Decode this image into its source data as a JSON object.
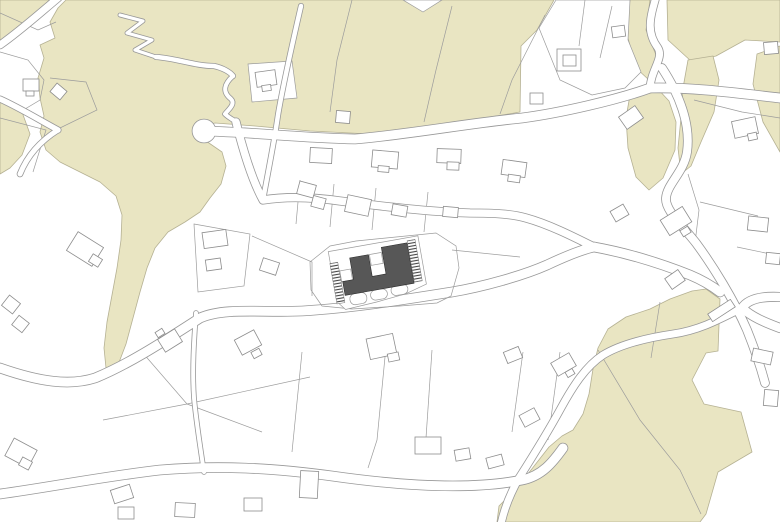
{
  "canvas": {
    "width": 780,
    "height": 522
  },
  "colors": {
    "background": "#ffffff",
    "vegetation_fill": "#e9e5c2",
    "vegetation_stroke": "#b5b193",
    "parcel_line": "#9c9c9c",
    "building_stroke": "#8d8d8d",
    "building_fill": "#ffffff",
    "road_edge": "#989898",
    "road_fill": "#ffffff",
    "project_fill": "#575757",
    "project_stroke": "#2e2e2e",
    "stair_hatch": "#454545",
    "plot_line": "#9c9c9c"
  },
  "vegetation": [
    {
      "name": "grove-top-left-corner",
      "points": "0,0 57,0 36,20 10,38 0,44"
    },
    {
      "name": "grove-main-north-mass",
      "points": "66,0 554,0 537,30 521,46 520,112 480,119 430,129 370,134 310,131 255,126 215,123 203,126 206,141 222,152 226,166 221,184 210,198 200,212 185,222 168,232 155,248 147,268 140,292 133,318 126,344 118,365 111,372 106,368 104,348 107,322 112,295 117,268 121,240 122,215 116,196 100,182 80,172 60,162 46,150 40,132 44,116 40,98 38,78 44,58 40,45 55,38 50,22 58,8"
    },
    {
      "name": "grove-top-right",
      "points": "667,0 780,0 780,42 745,40 716,56 692,62 668,40"
    },
    {
      "name": "grove-right-edge-strip",
      "points": "780,46 780,152 763,122 753,84 757,54"
    },
    {
      "name": "grove-sliver-west-of-lane",
      "points": "630,0 650,0 646,30 656,55 649,80 636,68 628,38 628,10"
    },
    {
      "name": "grove-mid-right-west",
      "points": "630,95 656,87 669,101 676,122 675,150 663,178 649,190 636,177 628,148 626,118"
    },
    {
      "name": "grove-mid-right-east",
      "points": "688,60 713,56 719,80 714,112 701,142 691,166 681,174 678,148 681,118 683,88"
    },
    {
      "name": "grove-southeast-mass",
      "points": "598,348 608,329 626,317 650,309 670,299 692,291 706,289 720,299 718,351 706,353 692,380 704,404 741,412 752,452 718,472 706,514 700,522 497,522 499,506 513,492 531,470 549,447 562,436 573,430 583,414 589,394 593,369"
    },
    {
      "name": "grove-west-edge-strip",
      "points": "0,98 22,112 30,134 22,155 10,168 0,174"
    }
  ],
  "white_patches": [
    {
      "name": "clearing-notch-top",
      "points": "403,0 442,0 423,12"
    },
    {
      "name": "parcel-top-right-white",
      "points": "556,0 630,0 628,40 641,72 625,88 592,95 560,80 539,28"
    },
    {
      "name": "parcel-in-grove",
      "points": "248,64 292,61 297,98 252,102"
    }
  ],
  "parcel_lines": [
    "M 0 13 L 38 30 L 56 22",
    "M 0 52 L 28 60 L 44 80 L 40 100 L 20 112",
    "M 0 118 L 46 130 L 33 172",
    "M 50 78 L 86 82 L 97 110 L 60 128",
    "M 352 0 L 337 60 L 330 112",
    "M 452 6 L 436 70 L 424 122",
    "M 545 15 L 512 80 L 500 114",
    "M 585 0 L 579 46",
    "M 612 6 L 600 58",
    "M 300 180 L 296 224",
    "M 334 184 L 330 227",
    "M 376 188 L 372 230",
    "M 428 192 L 424 232",
    "M 103 420 L 187 404 L 310 377",
    "M 187 404 L 142 352",
    "M 187 404 L 262 432",
    "M 302 352 L 292 452",
    "M 385 357 L 377 440 L 368 468",
    "M 432 350 L 426 438",
    "M 523 352 L 512 432",
    "M 560 352 L 548 440",
    "M 688 174 L 699 210 L 695 243",
    "M 700 202 L 758 216",
    "M 737 247 L 780 256",
    "M 694 100 L 742 112 L 780 118",
    "M 598 350 L 640 420 L 680 470 L 701 514",
    "M 660 302 L 651 358",
    "M 252 236 L 312 262 L 312 296",
    "M 452 250 L 520 257",
    "M 455 288 L 505 285",
    "M 194 224 L 250 234 L 244 286 L 198 292 Z"
  ],
  "roads": [
    {
      "name": "footpath-zigzag",
      "d": "M 120 15 L 143 21 L 127 33 L 152 40 L 135 50 L 156 57",
      "w": 3.2
    },
    {
      "name": "footpath-upper",
      "d": "M 156 57 C 175 58 195 66 214 66 C 223 68 230 72 233 76",
      "w": 4.5
    },
    {
      "name": "footpath-hook",
      "d": "M 233 76 C 224 84 222 92 231 99 C 236 104 228 110 225 114 C 229 118 234 120 236 122",
      "w": 4
    },
    {
      "name": "lane-north-diagonal",
      "d": "M 301 6 C 292 45 283 85 278 115 C 274 143 268 172 263 200",
      "w": 4.5
    },
    {
      "name": "street-middle",
      "d": "M 236 122 C 243 150 252 180 263 200 C 282 197 305 196 340 201 C 380 206 430 212 470 213 C 495 213 512 214 526 218 C 548 224 572 236 594 247",
      "w": 7.5
    },
    {
      "name": "street-north",
      "d": "M 204 131 C 252 132 300 138 355 139 C 412 134 470 123 522 118 C 560 113 617 100 650 88",
      "w": 9
    },
    {
      "name": "street-north-east",
      "d": "M 650 88 C 692 87 736 93 780 98",
      "w": 9
    },
    {
      "name": "lane-top-right",
      "d": "M 656 -3 C 650 18 646 32 658 48 C 664 58 651 70 650 88",
      "w": 7
    },
    {
      "name": "road-east-descending",
      "d": "M 662 68 C 679 94 691 124 687 152 C 684 172 667 184 666 198 C 665 210 681 224 696 243 C 713 266 734 300 747 330 C 755 350 761 368 765 383",
      "w": 8
    },
    {
      "name": "street-central-south",
      "d": "M 0 368 C 40 382 70 386 95 378 C 125 366 160 344 200 318 C 225 307 262 313 302 311 C 352 308 402 300 452 292 C 482 287 522 276 547 265 C 564 257 580 250 594 247",
      "w": 9
    },
    {
      "name": "street-east-link",
      "d": "M 594 247 C 622 252 657 262 690 275 C 702 280 712 286 720 292",
      "w": 9
    },
    {
      "name": "hairpin-upper-arm",
      "d": "M 780 297 C 762 296 748 299 742 308",
      "w": 8.5
    },
    {
      "name": "hairpin-lower-arm",
      "d": "M 742 308 C 752 317 764 322 780 328",
      "w": 8.5
    },
    {
      "name": "road-southeast-serpentine",
      "d": "M 742 308 C 720 319 700 330 673 334 C 646 338 621 344 603 355 C 586 366 573 386 561 408 C 549 430 533 456 519 478 C 510 494 504 510 501 524",
      "w": 7
    },
    {
      "name": "street-south",
      "d": "M 0 494 C 45 488 100 477 160 470 C 220 465 272 468 332 476 C 402 486 472 490 522 480 C 542 476 553 462 563 448",
      "w": 9
    },
    {
      "name": "footpath-vertical-south",
      "d": "M 196 313 C 194 340 192 370 194 398 C 196 420 200 446 204 472",
      "w": 4
    },
    {
      "name": "lane-top-left",
      "d": "M 58 -2 C 40 13 20 31 0 45",
      "w": 7
    },
    {
      "name": "footpath-west-1",
      "d": "M 58 130 C 36 118 18 107 0 99",
      "w": 5.5
    },
    {
      "name": "footpath-west-2",
      "d": "M 20 174 C 28 154 42 140 58 130",
      "w": 5
    }
  ],
  "culdesacs": [
    {
      "name": "turning-circle",
      "cx": 204,
      "cy": 131,
      "r": 11.5
    }
  ],
  "buildings": [
    [
      23,
      79,
      16,
      12,
      0
    ],
    [
      26,
      91,
      8,
      5,
      0
    ],
    [
      52,
      86,
      13,
      11,
      40
    ],
    [
      70,
      238,
      30,
      22,
      32
    ],
    [
      90,
      256,
      11,
      9,
      32
    ],
    [
      4,
      298,
      14,
      13,
      38
    ],
    [
      14,
      318,
      13,
      12,
      38
    ],
    [
      256,
      71,
      20,
      15,
      -8
    ],
    [
      262,
      85,
      9,
      6,
      -8
    ],
    [
      310,
      148,
      22,
      15,
      3
    ],
    [
      372,
      151,
      26,
      17,
      5
    ],
    [
      378,
      166,
      11,
      6,
      5
    ],
    [
      437,
      149,
      24,
      14,
      2
    ],
    [
      447,
      162,
      12,
      8,
      2
    ],
    [
      502,
      161,
      24,
      15,
      8
    ],
    [
      508,
      175,
      12,
      7,
      8
    ],
    [
      336,
      111,
      14,
      12,
      5
    ],
    [
      298,
      183,
      17,
      13,
      15
    ],
    [
      312,
      197,
      13,
      11,
      15
    ],
    [
      346,
      197,
      24,
      17,
      12
    ],
    [
      392,
      205,
      15,
      11,
      10
    ],
    [
      443,
      207,
      15,
      10,
      5
    ],
    [
      203,
      231,
      24,
      16,
      -8
    ],
    [
      206,
      259,
      15,
      11,
      -8
    ],
    [
      530,
      93,
      13,
      11,
      0
    ],
    [
      557,
      49,
      24,
      22,
      0
    ],
    [
      563,
      55,
      13,
      11,
      0
    ],
    [
      612,
      26,
      13,
      11,
      -8
    ],
    [
      621,
      110,
      20,
      15,
      -35
    ],
    [
      733,
      119,
      24,
      17,
      -12
    ],
    [
      748,
      133,
      9,
      7,
      -12
    ],
    [
      764,
      42,
      14,
      12,
      -5
    ],
    [
      612,
      207,
      15,
      12,
      -30
    ],
    [
      663,
      212,
      26,
      18,
      -32
    ],
    [
      681,
      228,
      9,
      7,
      -32
    ],
    [
      667,
      273,
      16,
      13,
      -35
    ],
    [
      708,
      306,
      27,
      9,
      -33
    ],
    [
      748,
      217,
      20,
      14,
      6
    ],
    [
      766,
      253,
      14,
      11,
      6
    ],
    [
      160,
      333,
      20,
      15,
      -32
    ],
    [
      156,
      330,
      8,
      6,
      -32
    ],
    [
      237,
      334,
      22,
      17,
      -28
    ],
    [
      252,
      350,
      9,
      7,
      -28
    ],
    [
      368,
      336,
      27,
      21,
      -12
    ],
    [
      388,
      353,
      11,
      8,
      -12
    ],
    [
      505,
      349,
      16,
      12,
      -22
    ],
    [
      553,
      357,
      21,
      15,
      -30
    ],
    [
      566,
      370,
      8,
      6,
      -30
    ],
    [
      521,
      411,
      17,
      13,
      -28
    ],
    [
      8,
      443,
      26,
      20,
      28
    ],
    [
      20,
      459,
      11,
      9,
      28
    ],
    [
      112,
      487,
      20,
      14,
      -18
    ],
    [
      300,
      471,
      18,
      27,
      3
    ],
    [
      118,
      507,
      16,
      12,
      0
    ],
    [
      175,
      503,
      20,
      14,
      3
    ],
    [
      244,
      498,
      18,
      13,
      0
    ],
    [
      415,
      437,
      26,
      17,
      0
    ],
    [
      455,
      449,
      15,
      11,
      -10
    ],
    [
      487,
      456,
      16,
      11,
      -15
    ],
    [
      752,
      350,
      20,
      13,
      12
    ],
    [
      764,
      390,
      14,
      16,
      5
    ],
    [
      261,
      260,
      17,
      13,
      18
    ]
  ],
  "project": {
    "tx": 338,
    "ty": 255,
    "rot": -10,
    "neighbor_parcel": "310,262 330,246 356,241 436,233 456,246 459,268 451,296 437,303 400,306 352,309 322,306 311,290",
    "plot_outline": "-9,-5 82,-5 82,44 60,50 30,53 -2,55 -9,46",
    "terraces": [
      [
        4,
        41,
        17,
        11
      ],
      [
        25,
        41,
        17,
        10
      ],
      [
        46,
        40,
        17,
        10
      ]
    ],
    "cells": [
      [
        -1,
        16,
        11,
        11
      ],
      [
        31,
        5,
        12,
        11
      ]
    ],
    "building_footprint": "0,27 11,27 11,5 30,5 30,27 44,27 44,0 70,0 70,41 0,41",
    "stairs": [
      [
        -9.5,
        7,
        8,
        41
      ],
      [
        70.5,
        -2,
        8,
        42
      ]
    ]
  }
}
